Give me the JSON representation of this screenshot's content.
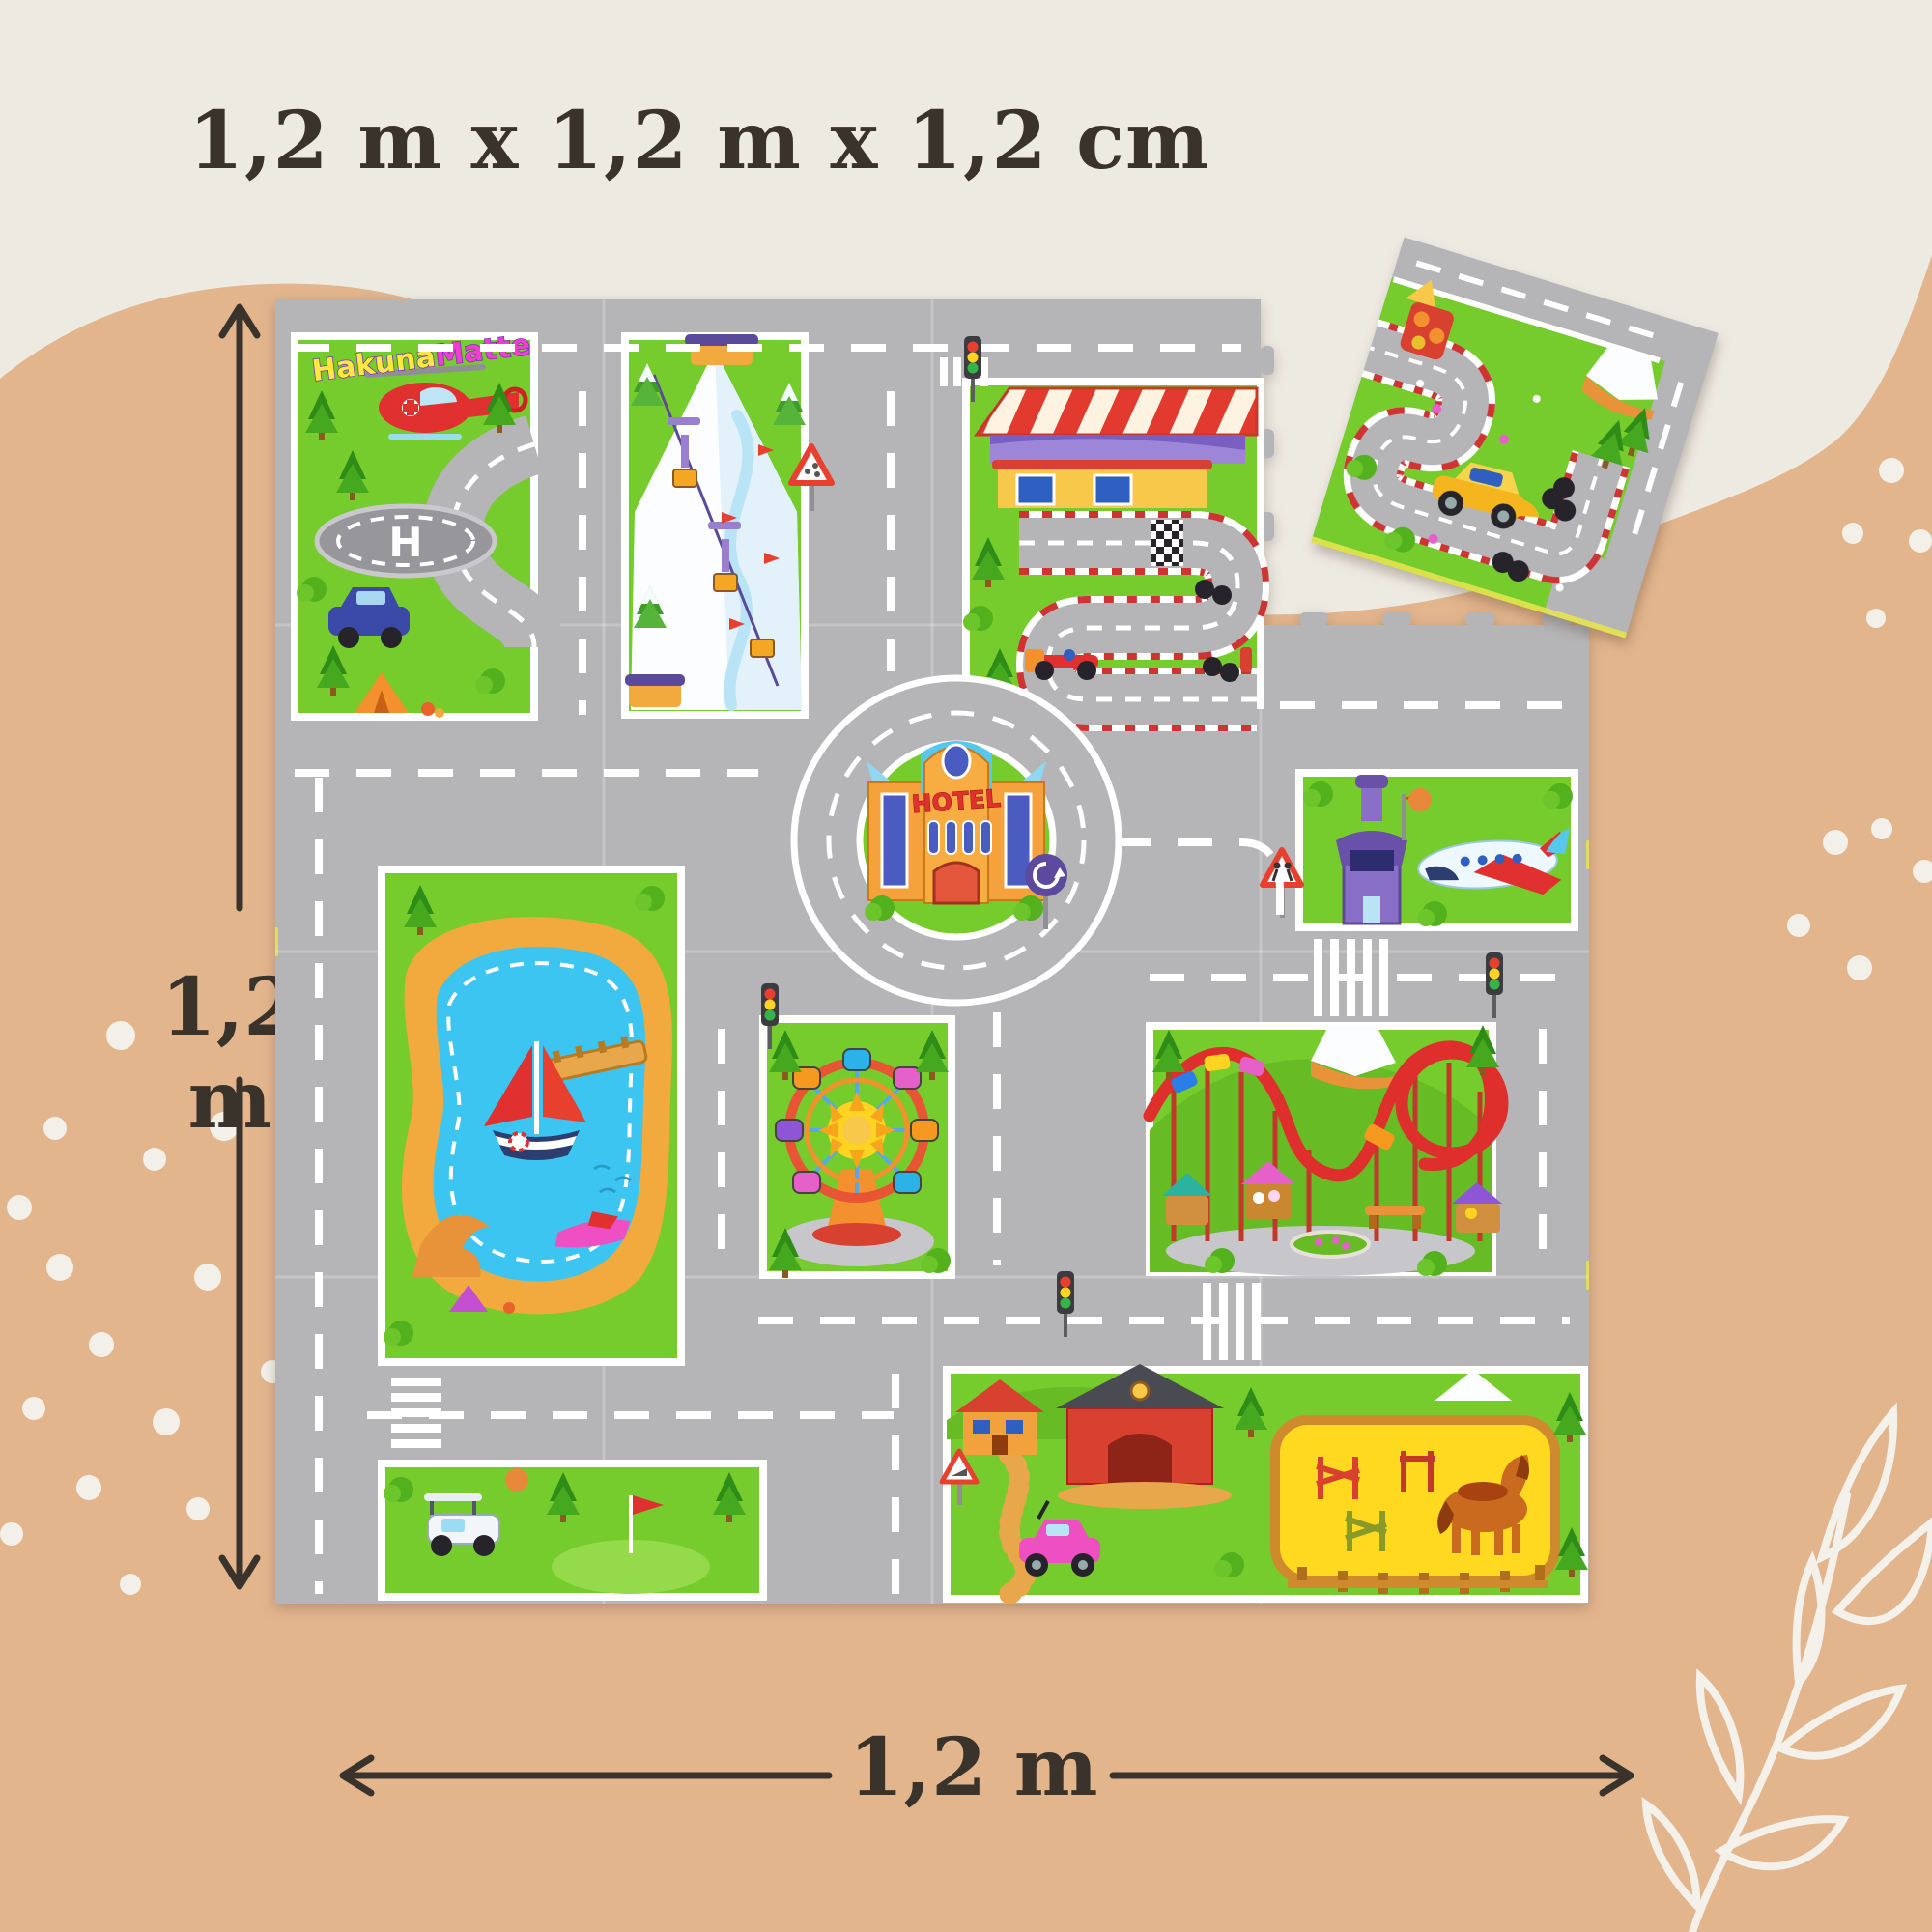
{
  "title": "1,2 m x 1,2 m x 1,2 cm",
  "dim_v": {
    "label": "1,2 m"
  },
  "dim_h": {
    "label": "1,2 m"
  },
  "mat": {
    "logo": {
      "part1": "Hakuna",
      "part2": "Matte"
    },
    "hotel_sign": "HOTEL",
    "helipad_mark": "H",
    "tiles": {
      "rows": 4,
      "cols": 4,
      "missing_tile": "top-right corner shown detached"
    },
    "scene_icons": [
      "helipad-with-rescue-helicopter",
      "ski-slope-with-gondola-lift",
      "race-circuit-with-grandstand",
      "hotel-roundabout",
      "airport-tower-and-plane",
      "lake-with-sailboat-and-jetski",
      "ferris-wheel",
      "roller-coaster-park",
      "golf-course-with-cart",
      "farm-house-and-barn",
      "horse-paddock",
      "campsite"
    ]
  },
  "colors": {
    "background_top": "#edeae2",
    "background_wave": "#e3b58d",
    "text": "#3a332b",
    "mat_road_gray": "#b5b4b7",
    "mat_grass_green": "#76cb2d",
    "coaster_red": "#df2f2c",
    "lake_blue": "#3cc5f0",
    "sand_orange": "#f2a93e",
    "logo_yellow": "#ffe93c",
    "logo_magenta": "#ee3fd0",
    "hotel_orange": "#f5a23d"
  },
  "decor": {
    "dots_left_cluster": 17,
    "dots_right_cluster": 9,
    "leaf_line_art": "bottom-right"
  }
}
